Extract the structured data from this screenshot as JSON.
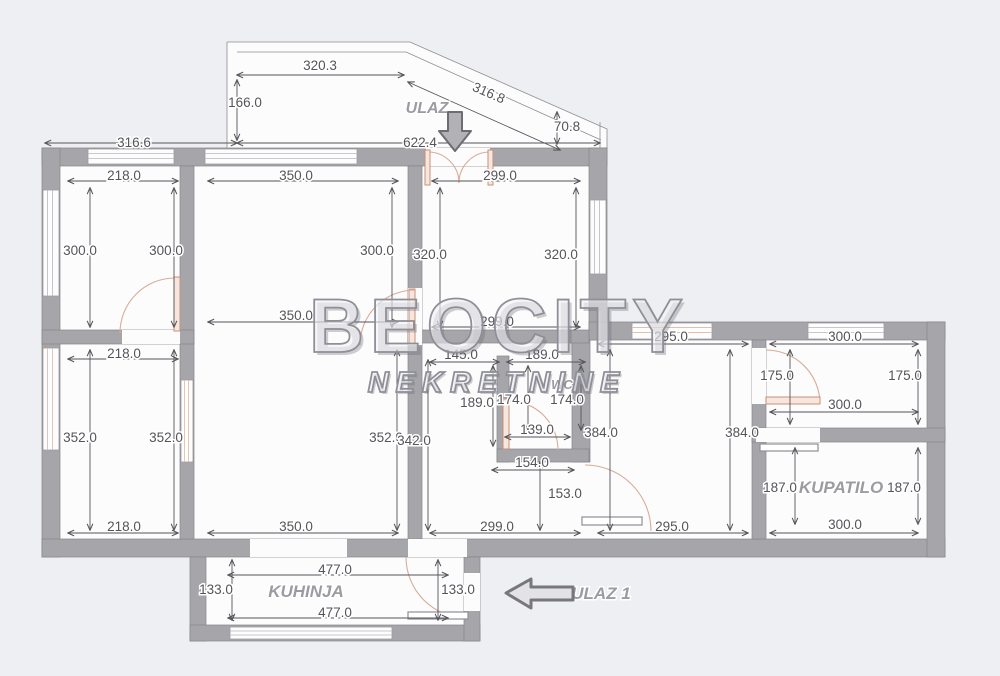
{
  "watermark": {
    "title": "BEOCITY",
    "subtitle": "NEKRETNINE"
  },
  "rooms": {
    "entrance": "ULAZ",
    "wc": "WC",
    "bathroom": "KUPATILO",
    "kitchen": "KUHINJA",
    "entrance_secondary": "ULAZ 1"
  },
  "colors": {
    "background": "#edeff3",
    "paper": "#fcfcfd",
    "wall": "#a6a6aa",
    "dimension_text": "#54545a",
    "door_accent": "#d9ab97",
    "room_label": "#9b9ba1"
  },
  "dims": {
    "balcony_width": "320.3",
    "balcony_height": "166.0",
    "balcony_slope": "316.8",
    "balcony_right_height": "70.8",
    "top_total_width": "622.4",
    "top_left_width": "316.6",
    "room1_width_top": "218.0",
    "living_width_top": "350.0",
    "hall_width_top": "299.0",
    "room1_height_left": "300.0",
    "room1_height_right": "300.0",
    "living_height_upper": "300.0",
    "hall_height_left": "320.0",
    "hall_height_right": "320.0",
    "living_width_mid": "350.0",
    "hall_width_mid": "299.0",
    "room2_width_top": "218.0",
    "niche_width": "145.0",
    "wc_width_top": "189.0",
    "wc_height": "189.0",
    "wc_width_left": "174.0",
    "wc_width_right": "174.0",
    "room2_height_left": "352.0",
    "room2_height_right": "352.0",
    "living_height_lower": "352.0",
    "corridor_height": "342.0",
    "wc_inner_width": "139.0",
    "wc_lower_width": "154.0",
    "passage_height": "153.0",
    "wing_room_height_left": "384.0",
    "wing_room_height_right": "384.0",
    "wing_room_width_top": "295.0",
    "top_right_room_width_top": "300.0",
    "top_right_room_height_left": "175.0",
    "top_right_room_height_right": "175.0",
    "top_right_room_width_bottom": "300.0",
    "bathroom_height_left": "187.0",
    "bathroom_height_right": "187.0",
    "room2_width_bottom": "218.0",
    "living_width_bottom": "350.0",
    "hall_width_bottom": "299.0",
    "wing_room_width_bottom": "295.0",
    "bathroom_width_bottom": "300.0",
    "kitchen_width_top": "477.0",
    "kitchen_height_left": "133.0",
    "kitchen_height_right": "133.0",
    "kitchen_width_bottom": "477.0"
  }
}
